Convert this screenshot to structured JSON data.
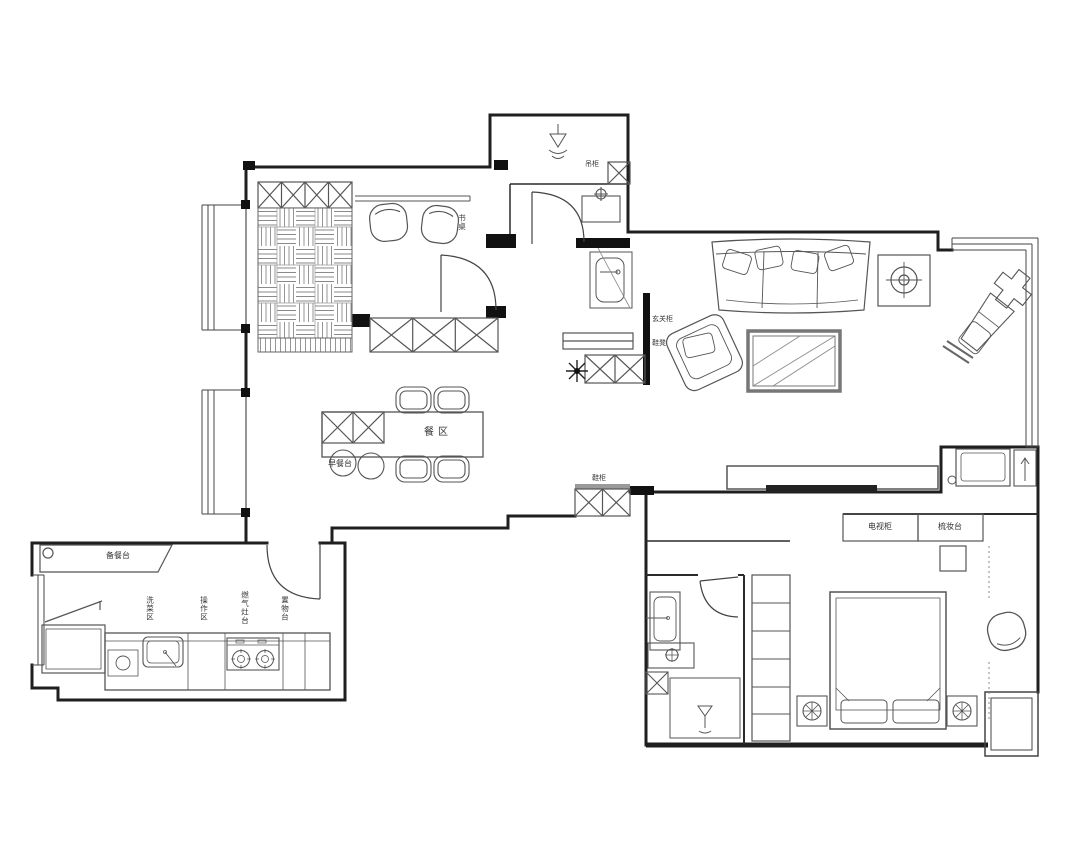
{
  "title": "apartment-floor-plan",
  "colors": {
    "background": "#ffffff",
    "wall": "#1f1f1f",
    "furniture": "#555555",
    "light_line": "#8a8a8a",
    "solid_fill": "#111111"
  },
  "labels": {
    "study_desk": "书桌",
    "utility_cabinet": "吊柜",
    "entry_cabinet": "玄关柜",
    "entry_bench": "鞋凳",
    "hall_shoe_cabinet": "鞋柜",
    "dining_zone": "餐区",
    "breakfast_bar": "早餐台",
    "prep_counter": "备餐台",
    "kitchen_wash": "洗菜区",
    "kitchen_prep": "操作区",
    "kitchen_stove": "燃气灶台",
    "kitchen_storage": "置物台",
    "bedroom_tv_cabinet": "电视柜",
    "bedroom_dresser": "梳妆台"
  }
}
